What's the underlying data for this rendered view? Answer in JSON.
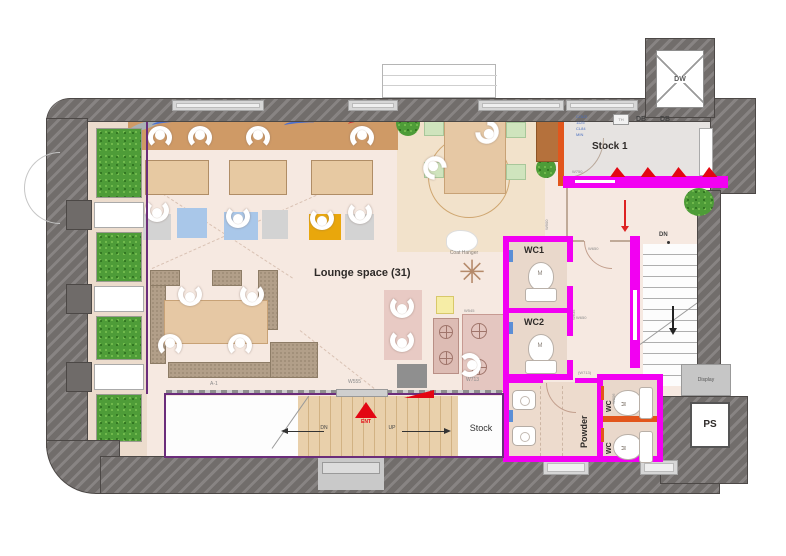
{
  "rooms": {
    "lounge": "Lounge space (31)",
    "stock1": "Stock 1",
    "stock": "Stock",
    "powder": "Powder",
    "wc1": "WC1",
    "wc2": "WC2",
    "wc": "WC",
    "ps": "PS",
    "dw": "DW",
    "display": "Display"
  },
  "labels": {
    "db": "DB",
    "th": "TH",
    "coat_hanger": "Coat Hanger",
    "a1": "A-1",
    "ent": "ENT",
    "dn": "DN",
    "up": "UP",
    "m": "M",
    "w750": "W750",
    "w555": "W555",
    "w713": "W713",
    "w713_paren": "(W713)",
    "w900": "W900",
    "w650": "W650",
    "w635": "W635",
    "w806": "W806",
    "w545": "W545",
    "stock1_note_1": "COLD",
    "stock1_note_2": "1125",
    "stock1_note_3": "CL84",
    "stock1_note_4": "MIN"
  },
  "colors": {
    "wall_gray": "#6f6b69",
    "magenta_wall": "#f200f2",
    "purple_outline": "#6b2d7b",
    "accent_red": "#e30613",
    "accent_orange": "#e2561c",
    "plant_green": "#4e9c38",
    "counter_brown": "#cf9a66",
    "mat_blue": "#a9c7e9",
    "mat_yellow": "#e9a70c",
    "floor_cream": "#f6e9e1"
  }
}
